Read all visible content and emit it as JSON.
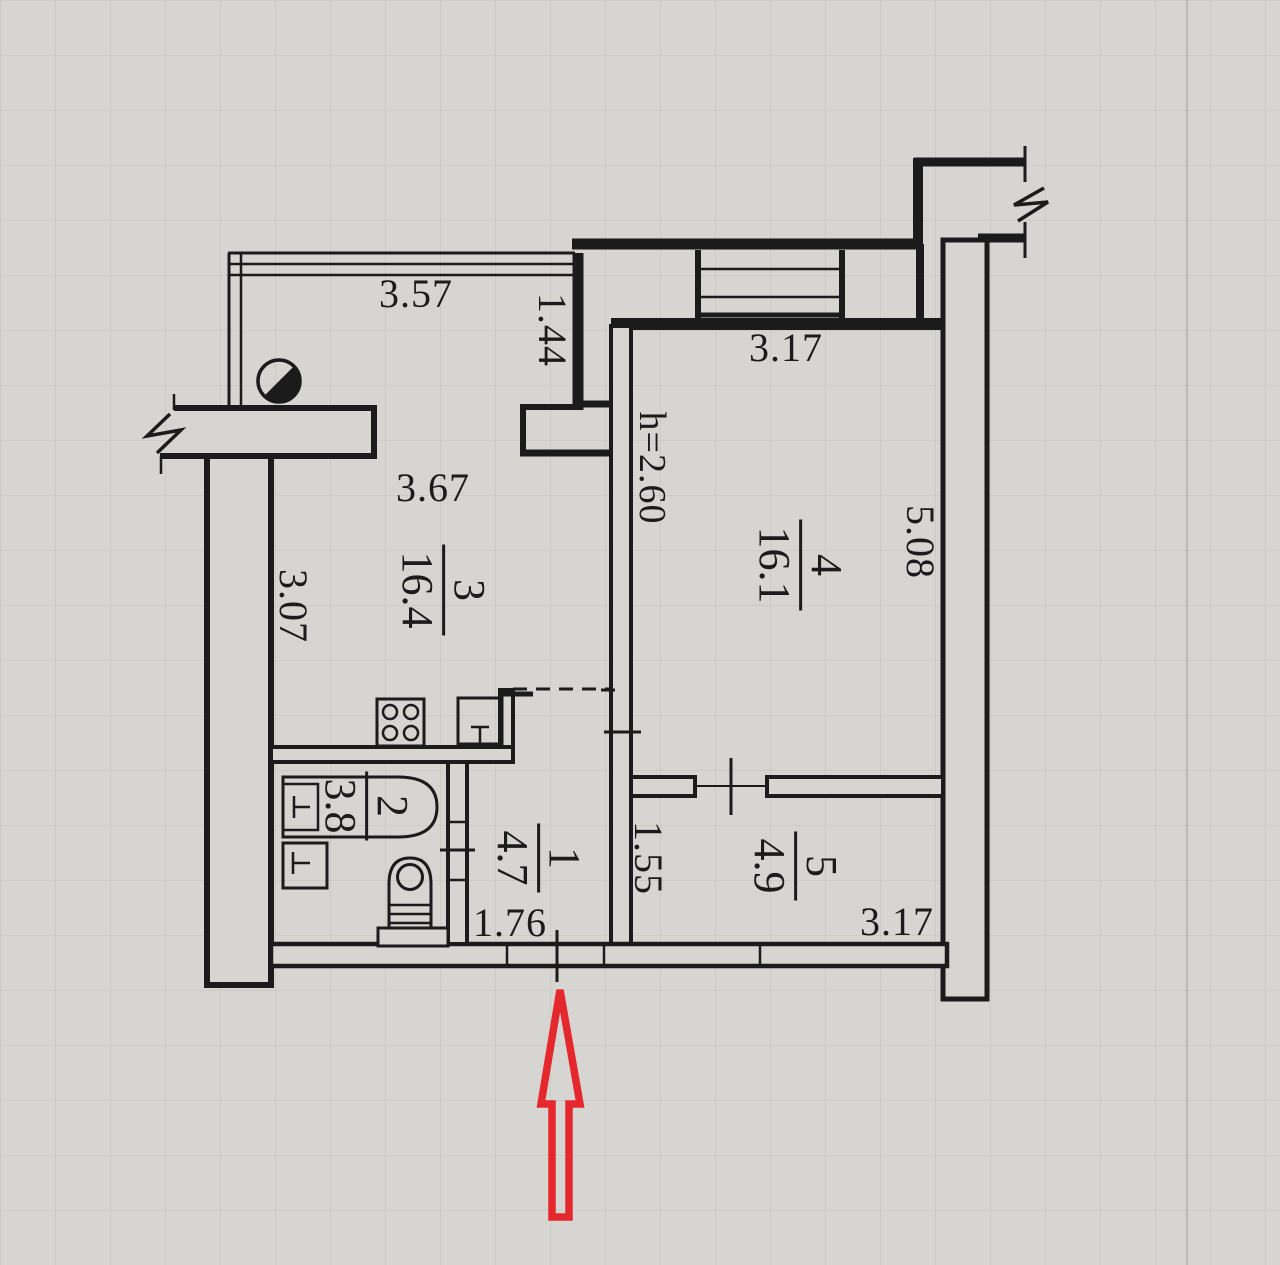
{
  "title": "Apartment floor plan",
  "colors": {
    "paper": "#d7d5d1",
    "ink": "#1b1b1b",
    "arrow_red": "#e5282d"
  },
  "rooms": [
    {
      "number": "1",
      "area": "4.7"
    },
    {
      "number": "2",
      "area": "3.8"
    },
    {
      "number": "3",
      "area": "16.4"
    },
    {
      "number": "4",
      "area": "16.1"
    },
    {
      "number": "5",
      "area": "4.9"
    }
  ],
  "dimensions": {
    "balcony_width": "3.57",
    "balcony_step": "1.44",
    "room4_top_width": "3.17",
    "room3_top_width": "3.67",
    "room3_left_height": "3.07",
    "room4_right_height": "5.08",
    "ceiling_height": "h=2.60",
    "room5_left_height": "1.55",
    "entrance_width": "1.76",
    "room5_bottom_width": "3.17"
  },
  "entrance_marker": {
    "shape": "arrow-up",
    "color": "#e5282d"
  }
}
